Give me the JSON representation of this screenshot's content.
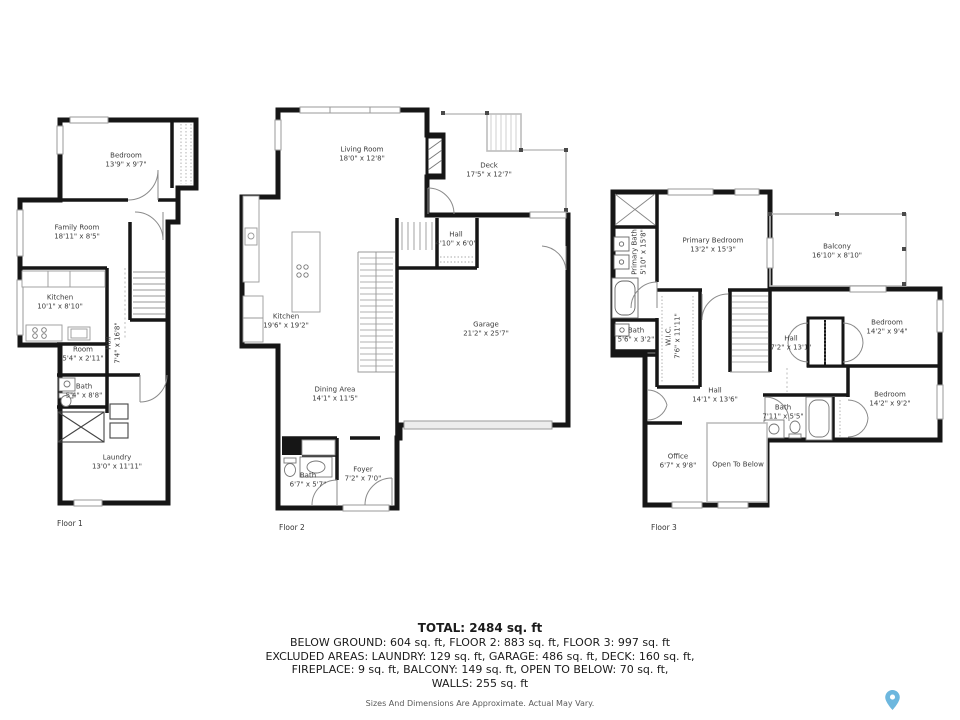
{
  "colors": {
    "wall": "#161616",
    "window": "#9a9a9a",
    "outdoor": "#bdbdbd",
    "pin_blue": "#6db7de"
  },
  "floors": [
    {
      "caption": "Floor 1",
      "rooms": [
        {
          "name": "Bedroom",
          "dims": "13'9\" x 9'7\""
        },
        {
          "name": "Family Room",
          "dims": "18'11\" x 8'5\""
        },
        {
          "name": "Kitchen",
          "dims": "10'1\" x 8'10\""
        },
        {
          "name": "Room",
          "dims": "5'4\" x 2'11\""
        },
        {
          "name": "Hall",
          "dims": "7'4\" x 16'8\""
        },
        {
          "name": "Bath",
          "dims": "5'4\" x 8'8\""
        },
        {
          "name": "Laundry",
          "dims": "13'0\" x 11'11\""
        }
      ]
    },
    {
      "caption": "Floor 2",
      "rooms": [
        {
          "name": "Living Room",
          "dims": "18'0\" x 12'8\""
        },
        {
          "name": "Deck",
          "dims": "17'5\" x 12'7\""
        },
        {
          "name": "Hall",
          "dims": "4'10\" x 6'0\""
        },
        {
          "name": "Kitchen",
          "dims": "19'6\" x 19'2\""
        },
        {
          "name": "Garage",
          "dims": "21'2\" x 25'7\""
        },
        {
          "name": "Dining Area",
          "dims": "14'1\" x 11'5\""
        },
        {
          "name": "Bath",
          "dims": "6'7\" x 5'7\""
        },
        {
          "name": "Foyer",
          "dims": "7'2\" x 7'0\""
        }
      ]
    },
    {
      "caption": "Floor 3",
      "rooms": [
        {
          "name": "Primary Bath",
          "dims": "5'10\" x 15'8\""
        },
        {
          "name": "Primary Bedroom",
          "dims": "13'2\" x 15'3\""
        },
        {
          "name": "Balcony",
          "dims": "16'10\" x 8'10\""
        },
        {
          "name": "Bath",
          "dims": "5'6\" x 3'2\""
        },
        {
          "name": "W.I.C.",
          "dims": "7'6\" x 11'11\""
        },
        {
          "name": "Hall",
          "dims": "7'2\" x 13'1\""
        },
        {
          "name": "Bedroom",
          "dims": "14'2\" x 9'4\""
        },
        {
          "name": "Hall",
          "dims": "14'1\" x 13'6\""
        },
        {
          "name": "Bath",
          "dims": "7'11\" x 5'5\""
        },
        {
          "name": "Office",
          "dims": "6'7\" x 9'8\""
        },
        {
          "name": "Open To Below",
          "dims": ""
        },
        {
          "name": "Bedroom",
          "dims": "14'2\" x 9'2\""
        }
      ]
    }
  ],
  "summary": {
    "total": "TOTAL: 2484 sq. ft",
    "lines": [
      "BELOW GROUND: 604 sq. ft, FLOOR 2: 883 sq. ft, FLOOR 3: 997 sq. ft",
      "EXCLUDED AREAS: LAUNDRY: 129 sq. ft, GARAGE: 486 sq. ft, DECK: 160 sq. ft,",
      "FIREPLACE: 9 sq. ft, BALCONY: 149 sq. ft, OPEN TO BELOW: 70 sq. ft,",
      "WALLS: 255 sq. ft"
    ],
    "disclaimer": "Sizes And Dimensions Are Approximate. Actual May Vary."
  },
  "icons": {
    "location_pin": "map-pin"
  }
}
